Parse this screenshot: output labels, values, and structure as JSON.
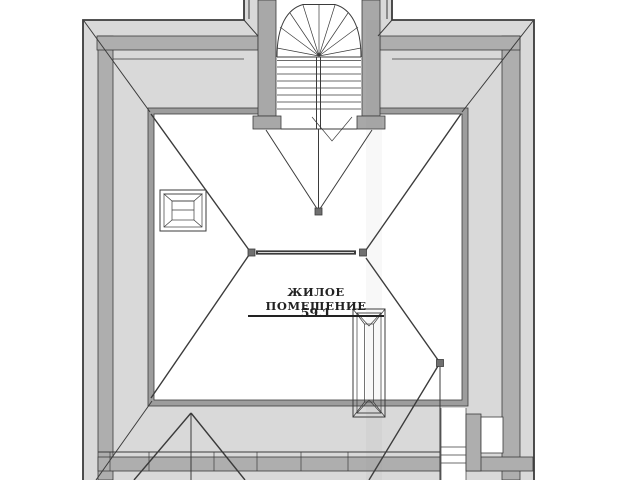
{
  "drawing": {
    "room_label": "ЖИЛОЕ ПОМЕЩЕНИЕ",
    "room_area": "59.1"
  },
  "colors": {
    "paper": "#ffffff",
    "line": "#3b3b3b",
    "band_light": "#d9d9d9",
    "band_dark": "#aeaeae",
    "wall": "#a8a8a8",
    "inner_band": "#9d9d9d",
    "node": "#707070",
    "text": "#222222"
  }
}
